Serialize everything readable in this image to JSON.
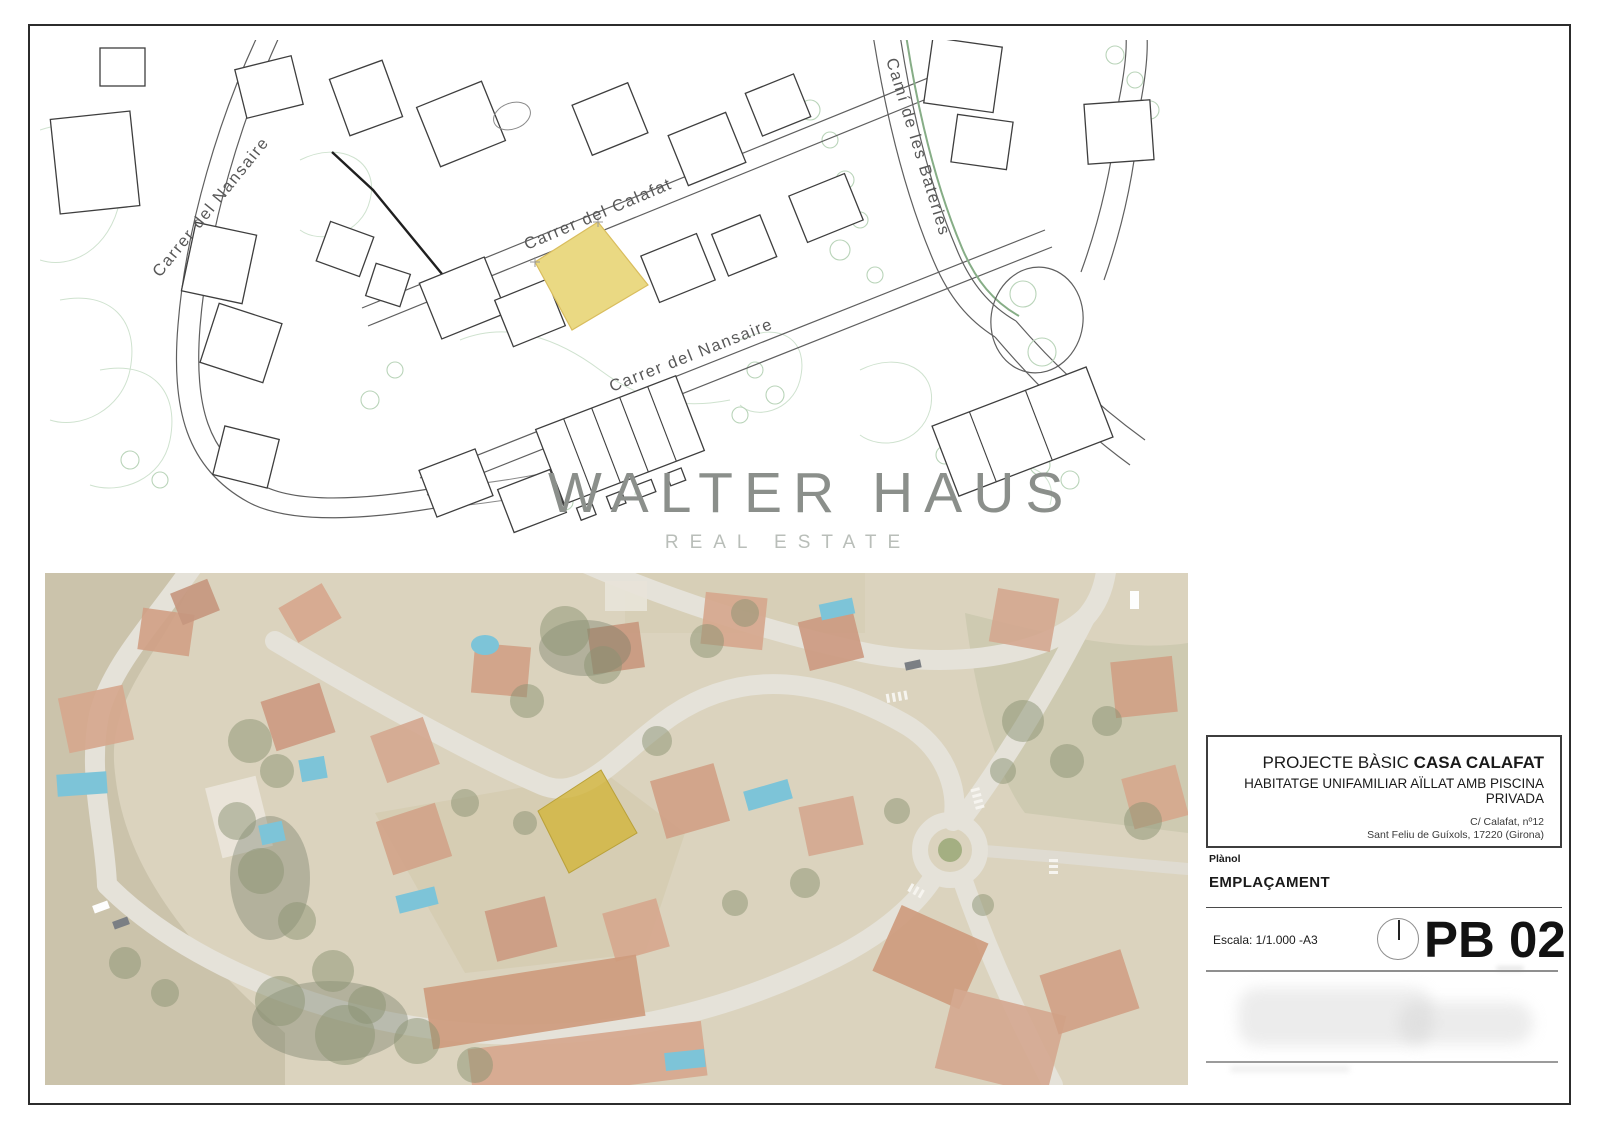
{
  "plan": {
    "label_nansaire_upper": "Carrer del Nansaire",
    "label_calafat": "Carrer del Calafat",
    "label_nansaire_lower": "Carrer del Nansaire",
    "label_bateries": "Camí de les Bateries"
  },
  "watermark": {
    "brand": "WALTER HAUS",
    "tagline": "REAL ESTATE"
  },
  "title_block": {
    "project_prefix": "PROJECTE BÀSIC",
    "project_name": "CASA CALAFAT",
    "subtitle": "HABITATGE UNIFAMILIAR AÏLLAT AMB PISCINA PRIVADA",
    "address_line1": "C/ Calafat, nº12",
    "address_line2": "Sant Feliu de Guíxols, 17220 (Girona)",
    "plan_label": "Plànol",
    "plan_name": "EMPLAÇAMENT",
    "scale_label": "Escala: 1/1.000 -A3",
    "sheet_code": "PB 02"
  },
  "colors": {
    "parcel_plan_fill": "#ead983",
    "parcel_aerial_fill": "#c7a30a"
  }
}
